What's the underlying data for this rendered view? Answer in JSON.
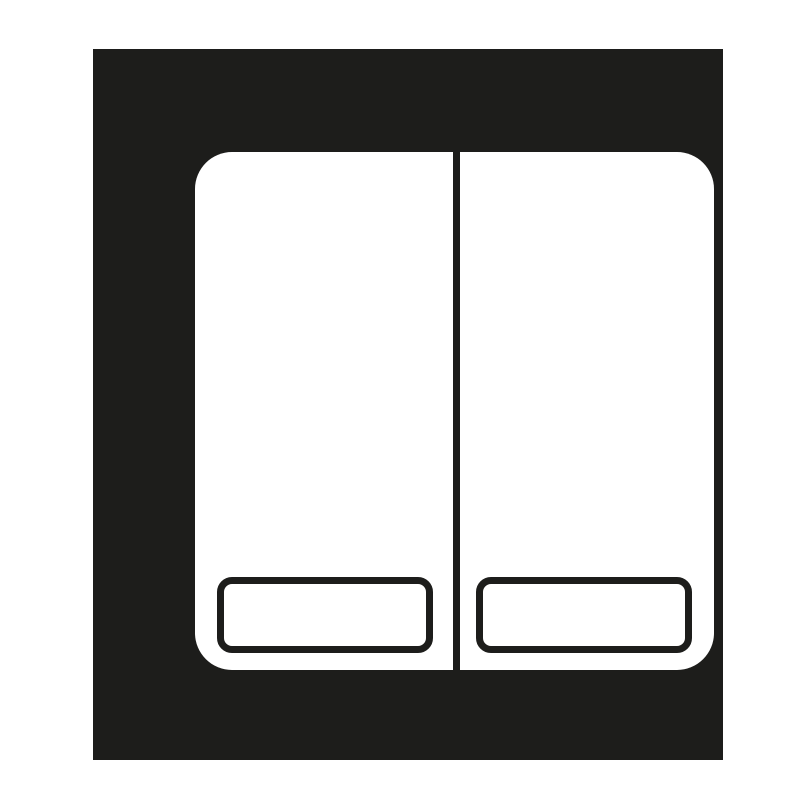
{
  "icon": {
    "semantic": "double-rocker-light-switch-icon"
  },
  "colors": {
    "foreground": "#1d1d1b",
    "background": "#ffffff"
  }
}
